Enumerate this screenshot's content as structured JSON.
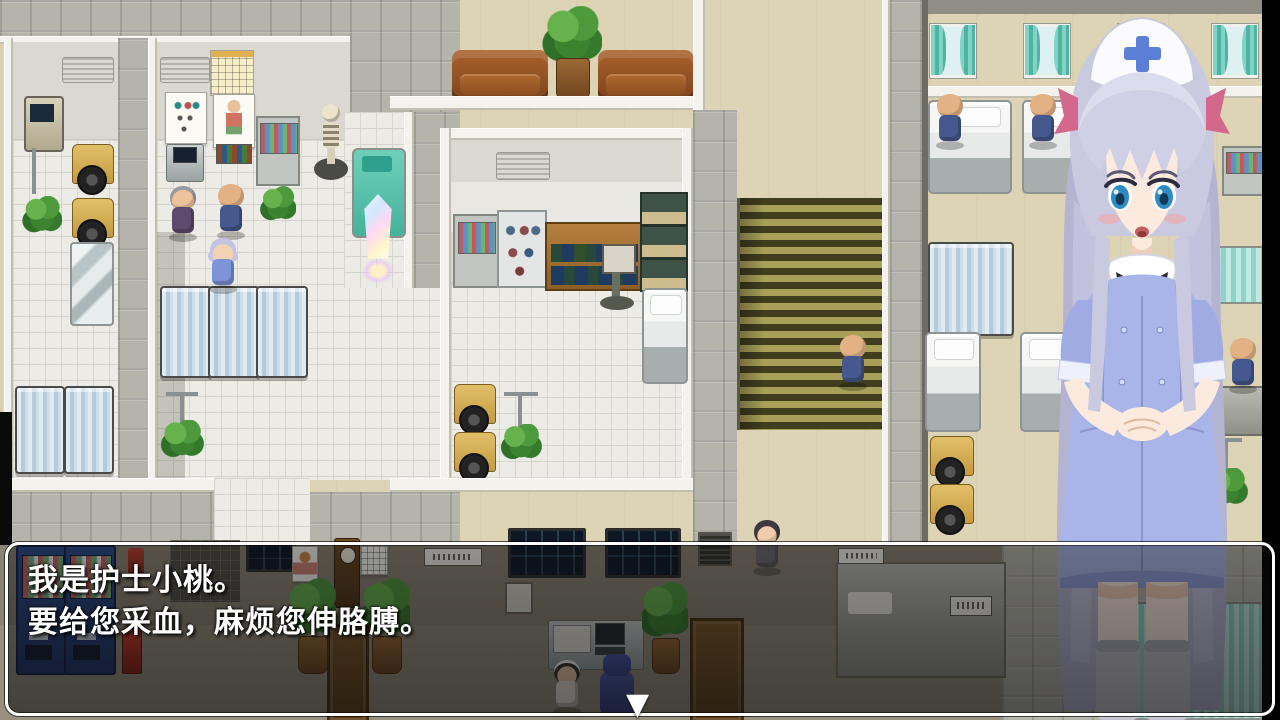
{
  "dialogue": {
    "speaker_intro": "我是护士小桃。",
    "request_line": "要给您采血，麻烦您伸胳膊。"
  },
  "icons": {
    "continue_indicator": "▼"
  },
  "colors": {
    "dialog_border": "#ffffff",
    "dialog_text": "#ffffff",
    "nurse_dress": "#a9b5e8",
    "nurse_hair": "#c9c9e0",
    "cap_cross": "#5b7fd4",
    "ribbon_pink": "#d3688c",
    "floor_beige": "#ddd4b5",
    "floor_tile": "#ecebe5",
    "stone_gray": "#b5b4ab",
    "stair_olive": "#a8a058",
    "curtain_teal": "#6ec9bc",
    "privacy_screen_blue": "#b5cbdb",
    "wheelchair_yellow": "#d9b45a",
    "couch_brown": "#9c5a28",
    "vending_blue": "#24407c",
    "save_crystal_glow": "#ffffff"
  }
}
